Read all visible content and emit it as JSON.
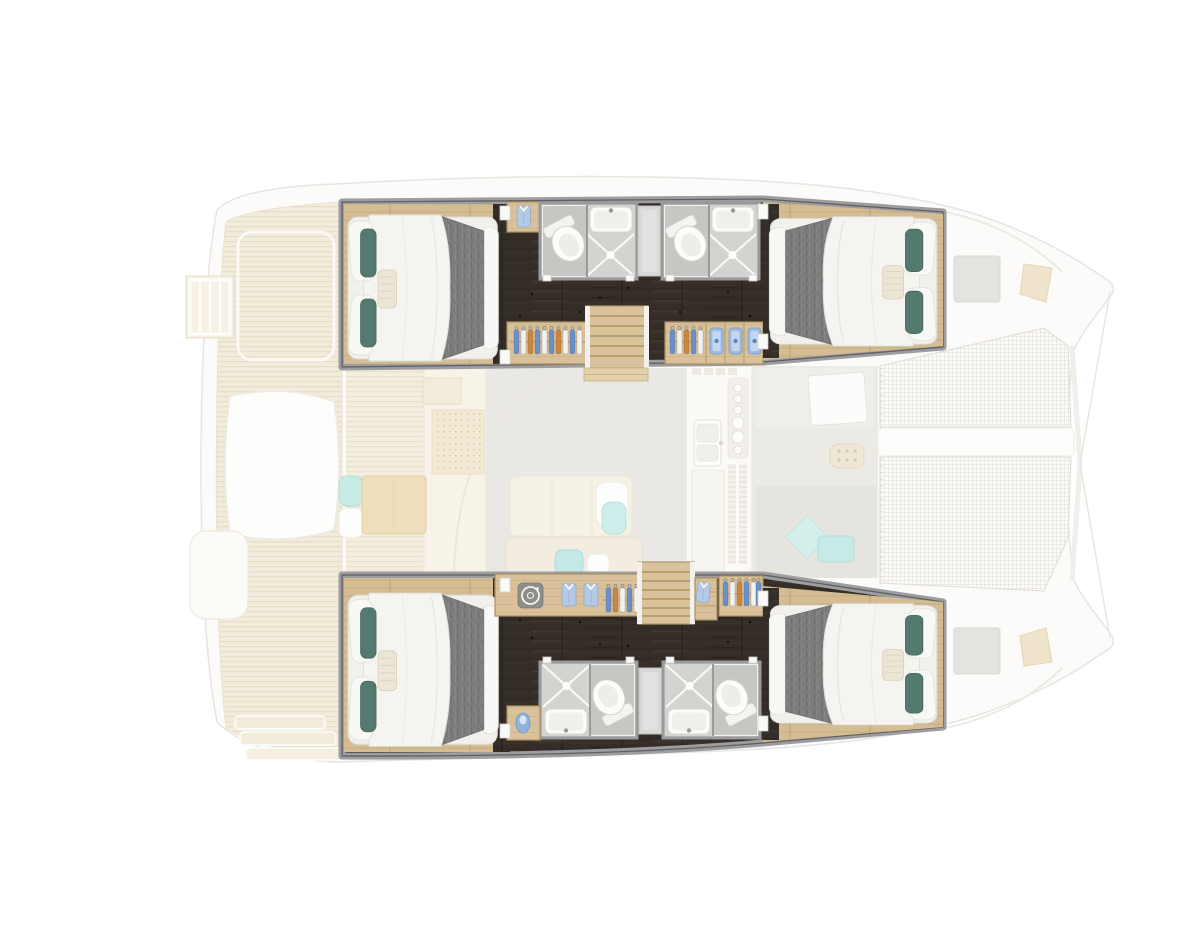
{
  "scene": {
    "kind": "catamaran-floor-plan",
    "aria_label": "Top-down floor plan of a sailing catamaran: four double cabins and four shower bathrooms highlighted in the two hulls, with the main deck (aft cockpit, saloon, galley, forward cockpit and bow trampolines) shown faded",
    "orientation": {
      "bow": "right",
      "stern": "left",
      "port_hull": "top",
      "starboard_hull": "bottom"
    }
  },
  "palette": {
    "background": "#ffffff",
    "wall_grey": "#9d9d9f",
    "corridor_dark_wood": "#352e28",
    "cabin_floor_wood": "#d4bc93",
    "wardrobe_wood": "#d9c29b",
    "stair_wood": "#d8c39c",
    "bathroom_floor": "#c6c6c3",
    "shower_floor": "#d3d3d0",
    "fixture_white": "#fbfbf9",
    "duvet_white": "#f5f4f1",
    "blanket_grey": "#7b7b7b",
    "pillow_teal": "#54796f",
    "accent_aqua": "#c6ebe6",
    "ghost_deck_wood": "#f2ecdc",
    "ghost_floor_grey": "#e9e8e4",
    "hanger_blue": "#6b8fc9",
    "hanger_orange": "#c9863f",
    "towel_blue": "#9cbce2"
  },
  "lower_deck": {
    "port_hull": {
      "position": "top",
      "cabins": [
        {
          "name": "port aft cabin",
          "bed": "double berth",
          "bed_head": "aft",
          "details": [
            "white duvet",
            "grey blanket",
            "two teal pillows",
            "striped bolster"
          ]
        },
        {
          "name": "port forward cabin",
          "bed": "double berth",
          "bed_head": "forward",
          "details": [
            "white duvet",
            "grey blanket",
            "two teal pillows",
            "striped bolster"
          ]
        }
      ],
      "bathrooms": [
        {
          "name": "port aft bathroom",
          "fixtures": [
            "toilet",
            "washbasin",
            "shower"
          ]
        },
        {
          "name": "port forward bathroom",
          "fixtures": [
            "toilet",
            "washbasin",
            "shower"
          ]
        }
      ],
      "storage": [
        {
          "name": "port aft wardrobe",
          "contents": [
            "hanging clothes"
          ]
        },
        {
          "name": "port forward wardrobe",
          "contents": [
            "hanging clothes",
            "three rolled towels"
          ]
        },
        {
          "name": "port aft cabinet",
          "contents": [
            "folded shirt"
          ]
        }
      ],
      "stairs": {
        "name": "port companionway",
        "treads": 6
      }
    },
    "starboard_hull": {
      "position": "bottom",
      "cabins": [
        {
          "name": "starboard aft cabin",
          "bed": "double berth",
          "bed_head": "aft",
          "details": [
            "white duvet",
            "grey blanket",
            "two teal pillows",
            "striped bolster"
          ]
        },
        {
          "name": "starboard forward cabin",
          "bed": "double berth",
          "bed_head": "forward",
          "details": [
            "white duvet",
            "grey blanket",
            "two teal pillows",
            "striped bolster"
          ]
        }
      ],
      "bathrooms": [
        {
          "name": "starboard aft bathroom",
          "fixtures": [
            "toilet",
            "washbasin",
            "shower"
          ]
        },
        {
          "name": "starboard forward bathroom",
          "fixtures": [
            "toilet",
            "washbasin",
            "shower"
          ]
        }
      ],
      "storage": [
        {
          "name": "starboard aft wardrobe",
          "contents": [
            "washing machine",
            "two folded shirts",
            "hanging clothes"
          ]
        },
        {
          "name": "starboard shelf unit",
          "contents": [
            "folded shirt"
          ]
        },
        {
          "name": "starboard forward wardrobe",
          "contents": [
            "hanging clothes"
          ]
        },
        {
          "name": "starboard aft cabinet",
          "contents": [
            "blue jug"
          ]
        }
      ],
      "stairs": {
        "name": "starboard companionway",
        "treads": 6
      }
    },
    "totals": {
      "double_cabins": 4,
      "bathrooms": 4,
      "toilets": 4,
      "showers": 4,
      "washbasins": 4,
      "companionways": 2,
      "washing_machines": 1
    }
  },
  "main_deck_faded": {
    "areas": [
      {
        "name": "aft cockpit",
        "items": [
          "teak deck planking",
          "swim ladder",
          "cockpit table",
          "bench seating",
          "aqua cushions",
          "transom steps"
        ]
      },
      {
        "name": "saloon",
        "items": [
          "sofa",
          "chaise with aqua towel",
          "navigation desk",
          "perforated panel",
          "bench with aqua cushions"
        ]
      },
      {
        "name": "galley",
        "items": [
          "double sink",
          "stove control knobs",
          "vent slits",
          "louvered panels"
        ]
      },
      {
        "name": "forward cockpit",
        "items": [
          "table",
          "grill pad",
          "aqua diamond cushion",
          "bench seating"
        ]
      },
      {
        "name": "foredeck",
        "items": [
          "two trampolines",
          "center walkway",
          "two deck hatches",
          "two anchor fittings",
          "bow bridle lines"
        ]
      }
    ]
  },
  "icons": [
    {
      "name": "washer-icon",
      "meaning": "washing machine drum"
    },
    {
      "name": "shirt-icon",
      "meaning": "folded shirt"
    },
    {
      "name": "hanger-icon",
      "meaning": "hanging garment"
    },
    {
      "name": "towel-icon",
      "meaning": "rolled towel"
    },
    {
      "name": "shower-icon",
      "meaning": "shower floor with drain"
    }
  ]
}
